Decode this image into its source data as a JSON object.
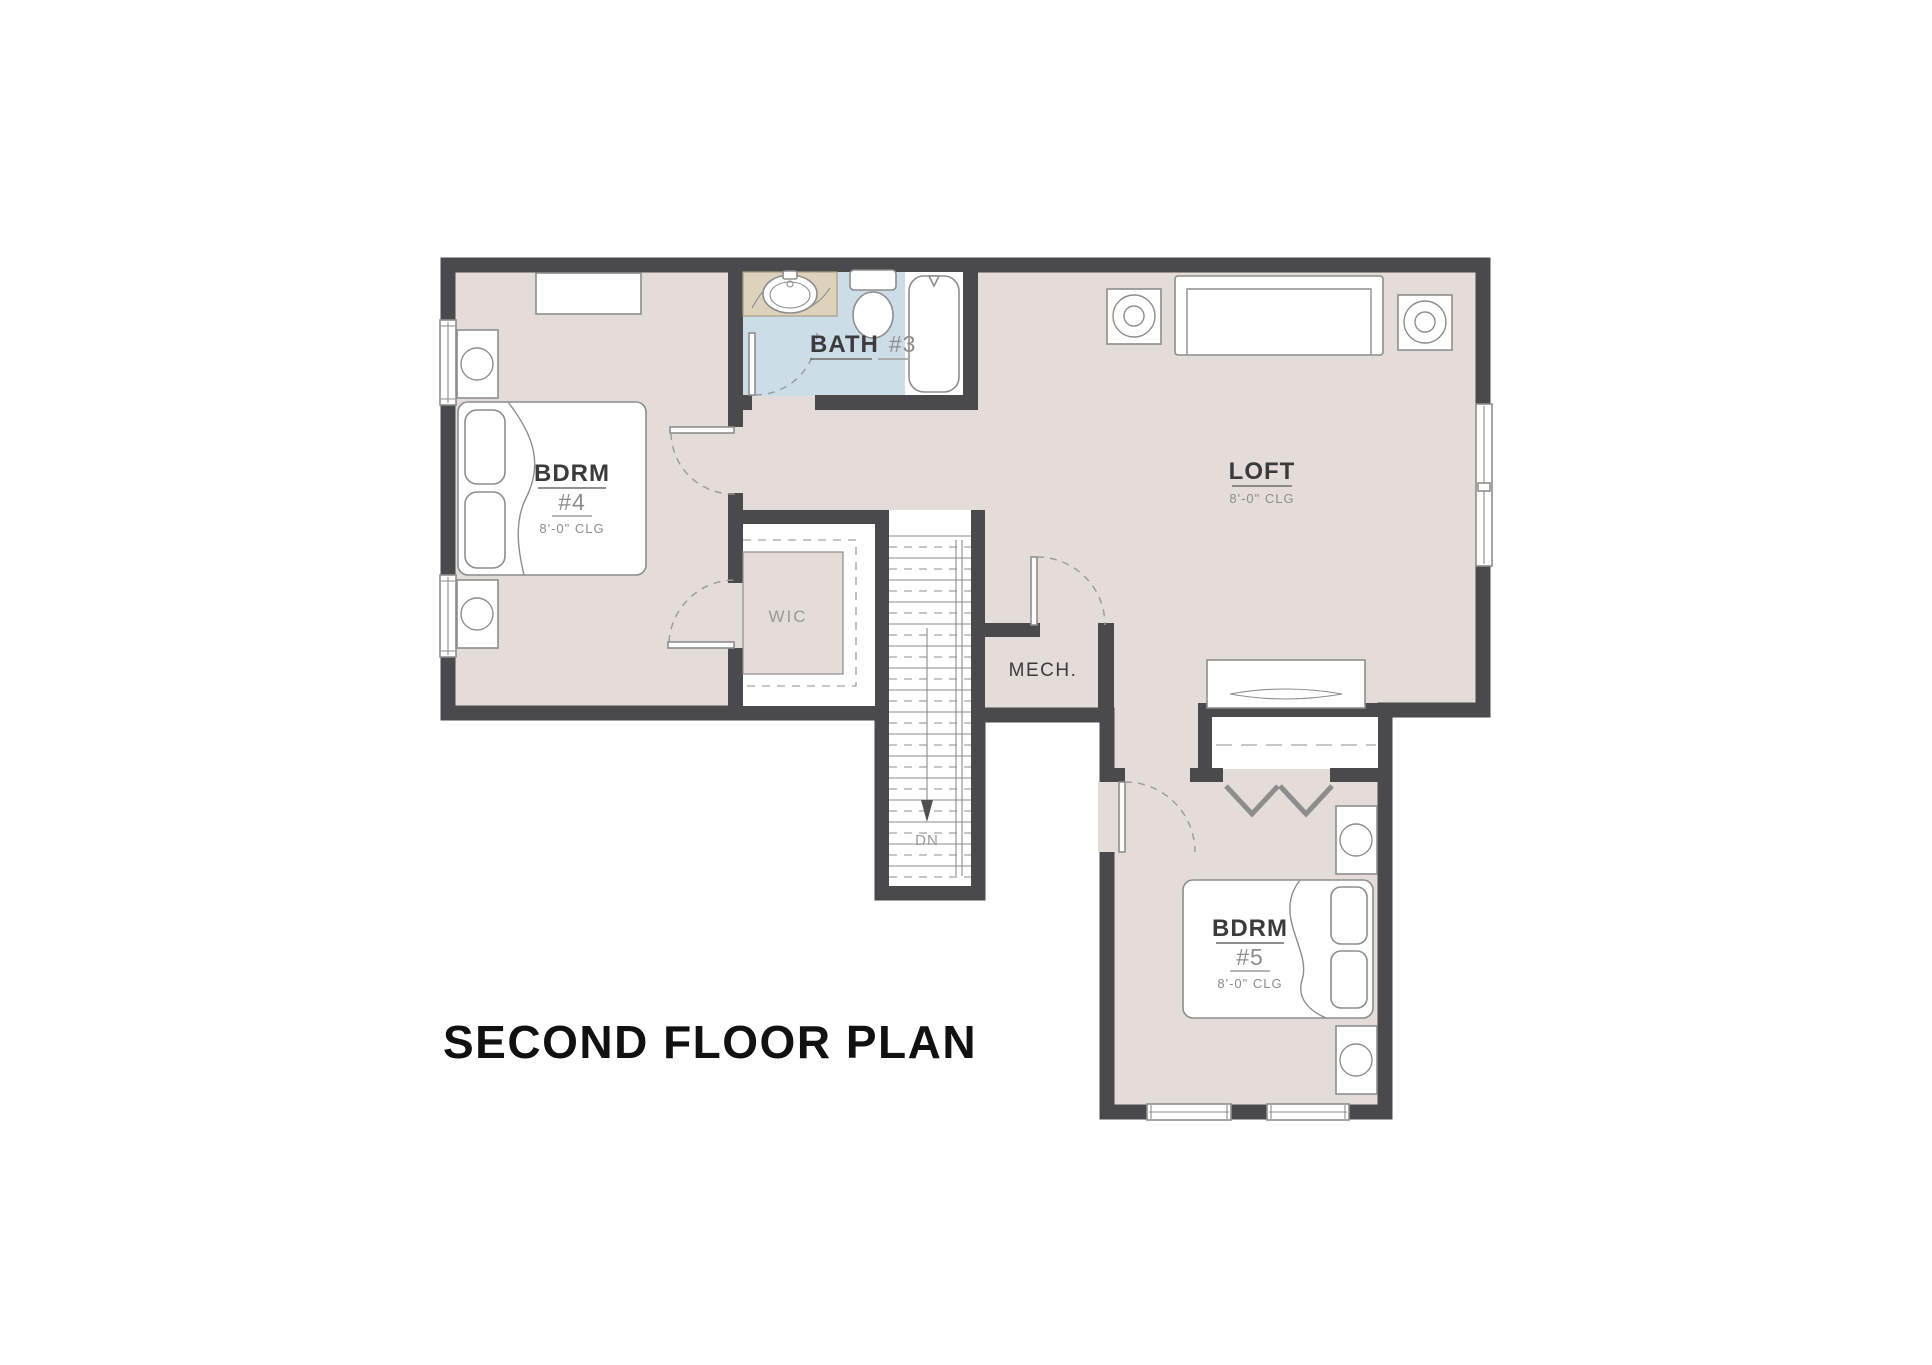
{
  "page": {
    "title": "SECOND FLOOR PLAN"
  },
  "rooms": {
    "bdrm4": {
      "name": "BDRM",
      "number": "#4",
      "ceiling": "8'-0\" CLG"
    },
    "bath3": {
      "name": "BATH",
      "number": "#3"
    },
    "loft": {
      "name": "LOFT",
      "ceiling": "8'-0\" CLG"
    },
    "wic": {
      "name": "WIC"
    },
    "mech": {
      "name": "MECH."
    },
    "stairs": {
      "down_label": "DN"
    },
    "bdrm5": {
      "name": "BDRM",
      "number": "#5",
      "ceiling": "8'-0\" CLG"
    }
  },
  "colors": {
    "wall": "#4a4a4c",
    "floor": "#e4dcd8",
    "bath_floor": "#ccdde8",
    "marble": "#ddd2bc",
    "line": "#8d8d8d",
    "label_dark": "#3b3b3d",
    "label_gray": "#8f8d8b",
    "label_light": "#9b9a98",
    "title": "#111111"
  }
}
